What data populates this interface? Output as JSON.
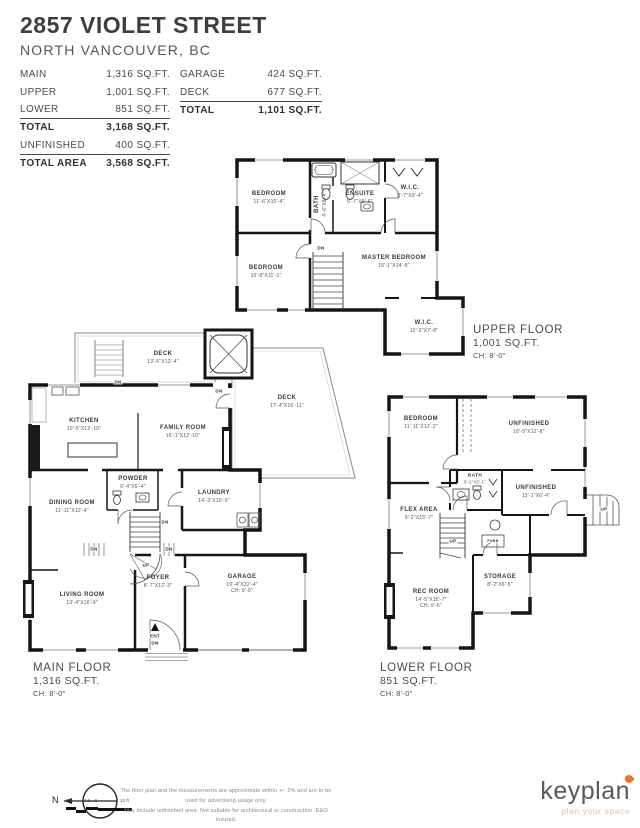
{
  "header": {
    "title": "2857 VIOLET STREET",
    "subtitle": "NORTH VANCOUVER, BC"
  },
  "area_table": {
    "left_rows": [
      {
        "label": "MAIN",
        "value": "1,316 SQ.FT."
      },
      {
        "label": "UPPER",
        "value": "1,001 SQ.FT."
      },
      {
        "label": "LOWER",
        "value": "851 SQ.FT."
      },
      {
        "label": "TOTAL",
        "value": "3,168 SQ.FT."
      },
      {
        "label": "UNFINISHED",
        "value": "400 SQ.FT."
      },
      {
        "label": "TOTAL AREA",
        "value": "3,568 SQ.FT."
      }
    ],
    "right_rows": [
      {
        "label": "GARAGE",
        "value": "424 SQ.FT."
      },
      {
        "label": "DECK",
        "value": "677 SQ.FT."
      },
      {
        "label": "TOTAL",
        "value": "1,101 SQ.FT."
      }
    ]
  },
  "floors": {
    "upper": {
      "label": "UPPER FLOOR",
      "area": "1,001 SQ.FT.",
      "ch": "CH: 8'-0\"",
      "rooms": [
        {
          "name": "BEDROOM",
          "dims": "11'-6\"X10'-4\""
        },
        {
          "name": "BATH",
          "dims": "4'-6\"X8'-4\""
        },
        {
          "name": "ENSUITE",
          "dims": "6'-7\"X9'-6\""
        },
        {
          "name": "W.I.C.",
          "dims": "8'-7\"X9'-4\""
        },
        {
          "name": "BEDROOM",
          "dims": "10'-8\"X11'-1\""
        },
        {
          "name": "MASTER BEDROOM",
          "dims": "15'-1\"X14'-8\""
        },
        {
          "name": "W.I.C.",
          "dims": "12'-2\"X7'-8\""
        }
      ]
    },
    "main": {
      "label": "MAIN FLOOR",
      "area": "1,316 SQ.FT.",
      "ch": "CH: 8'-0\"",
      "rooms": [
        {
          "name": "DECK",
          "dims": "13'-5\"X12'-4\""
        },
        {
          "name": "DECK",
          "dims": "17'-4\"X16'-11\""
        },
        {
          "name": "KITCHEN",
          "dims": "10'-5\"X12'-10\""
        },
        {
          "name": "FAMILY ROOM",
          "dims": "16'-1\"X12'-10\""
        },
        {
          "name": "POWDER",
          "dims": "6'-4\"X5'-4\""
        },
        {
          "name": "LAUNDRY",
          "dims": "14'-3\"X10'-0\""
        },
        {
          "name": "DINING ROOM",
          "dims": "11'-11\"X12'-4\""
        },
        {
          "name": "FOYER",
          "dims": "8'-7\"X12'-3\""
        },
        {
          "name": "LIVING ROOM",
          "dims": "13'-4\"X16'-9\""
        },
        {
          "name": "GARAGE",
          "dims": "19'-4\"X22'-4\"",
          "ch": "CH: 9'-0\""
        }
      ]
    },
    "lower": {
      "label": "LOWER FLOOR",
      "area": "851 SQ.FT.",
      "ch": "CH: 8'-0\"",
      "rooms": [
        {
          "name": "BEDROOM",
          "dims": "11'-11\"X12'-2\""
        },
        {
          "name": "UNFINISHED",
          "dims": "16'-5\"X12'-8\""
        },
        {
          "name": "BATH",
          "dims": "8'-2\"X5'-1\""
        },
        {
          "name": "UNFINISHED",
          "dims": "13'-1\"X6'-4\""
        },
        {
          "name": "FLEX AREA",
          "dims": "9'-2\"X15'-7\""
        },
        {
          "name": "STORAGE",
          "dims": "8'-2\"X6'-5\""
        },
        {
          "name": "REC ROOM",
          "dims": "14'-5\"X15'-7\"",
          "ch": "CH: 9'-6\""
        }
      ]
    }
  },
  "annotations": {
    "dn": "DN",
    "up": "UP",
    "ent": "ENT",
    "furn": "FURN"
  },
  "footer": {
    "north_label": "N",
    "scale_ticks": [
      "0 ft",
      "2.5",
      "5",
      "10 ft"
    ],
    "disclaimer_line1": "The floor plan and the measurements are approximate within +/- 2% and are to be used for advertising usage only.",
    "disclaimer_line2": "May include unfinished area. Not suitable for architectural or construction. E&O Insured.",
    "brand": {
      "logo_text": "keyplan",
      "tagline": "plan your space",
      "logo_color": "#58595b",
      "accent_color": "#f4731f",
      "tagline_color": "#e9bd98"
    }
  },
  "colors": {
    "wall": "#161616",
    "text_dark": "#3e3e3e",
    "text_mid": "#555555"
  }
}
